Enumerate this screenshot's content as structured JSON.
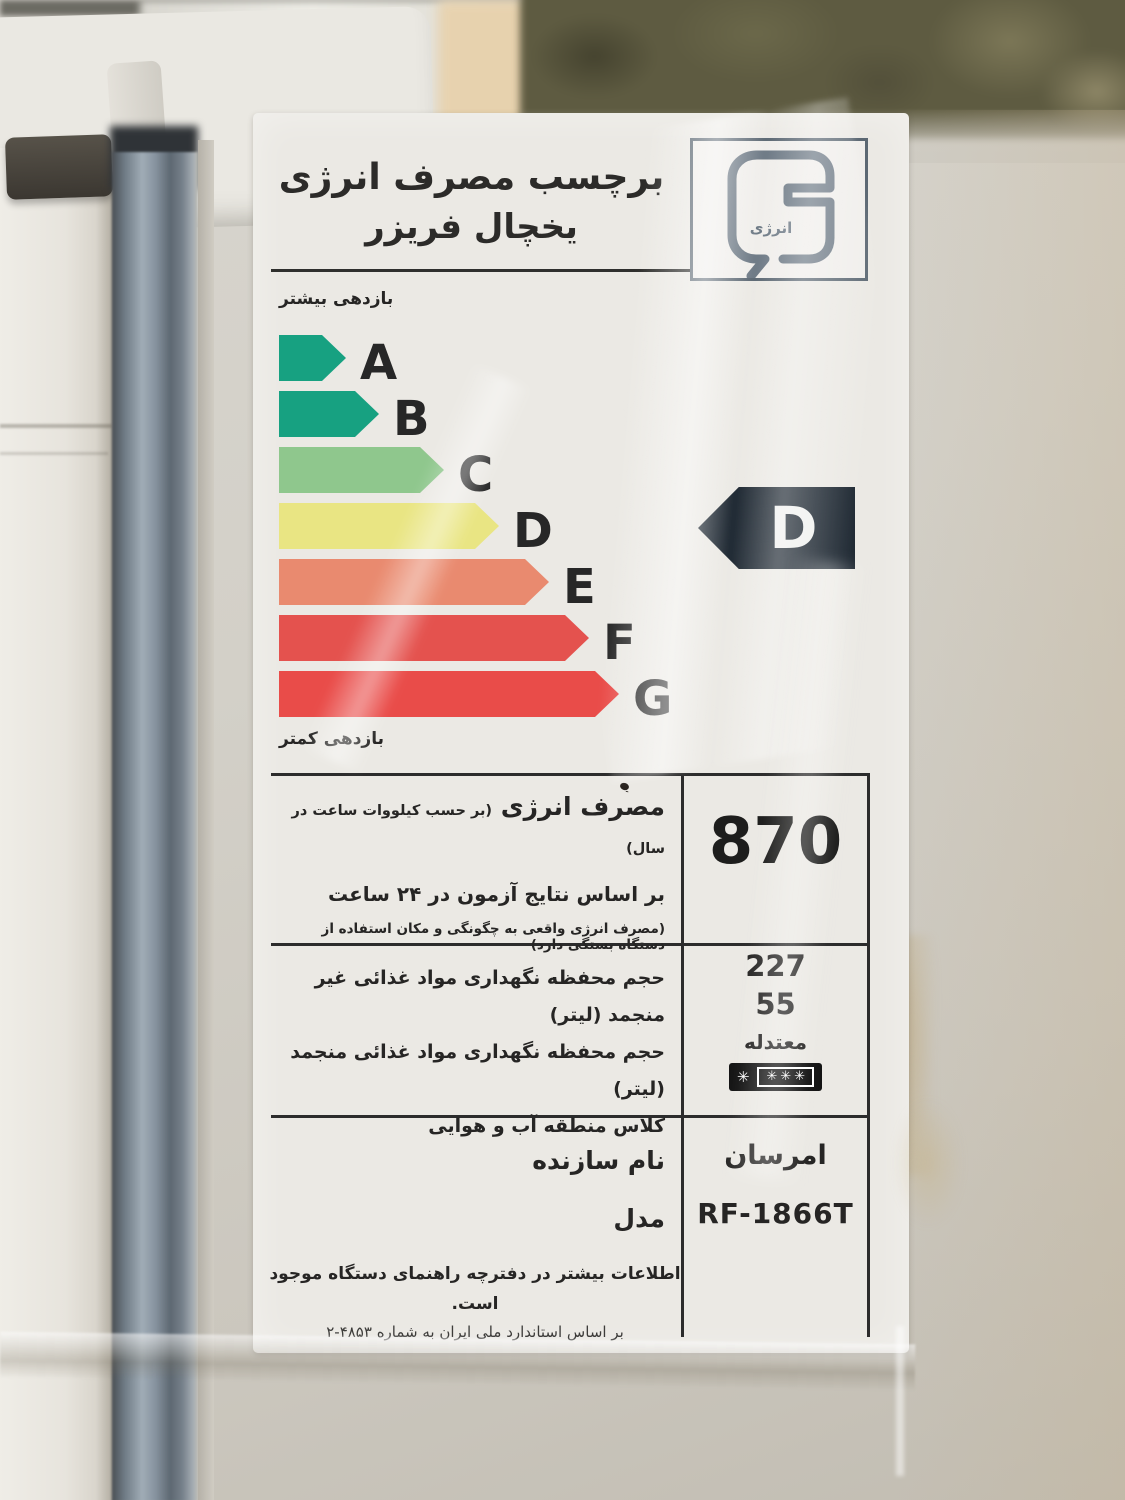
{
  "label": {
    "title_line1": "برچسب مصرف انرژی",
    "title_line2": "یخچال فریزر",
    "logo": {
      "text": "انرژی",
      "color": "#6d7985"
    },
    "scale": {
      "more_label": "بازدهی بیشتر",
      "less_label": "بازدهی کمتر",
      "grades": [
        {
          "letter": "A",
          "color": "#17a181",
          "width_px": 67
        },
        {
          "letter": "B",
          "color": "#17a181",
          "width_px": 100
        },
        {
          "letter": "C",
          "color": "#8fc78d",
          "width_px": 165
        },
        {
          "letter": "D",
          "color": "#e9e583",
          "width_px": 220
        },
        {
          "letter": "E",
          "color": "#e98a6f",
          "width_px": 270
        },
        {
          "letter": "F",
          "color": "#e4524e",
          "width_px": 310
        },
        {
          "letter": "G",
          "color": "#e94c49",
          "width_px": 340
        }
      ],
      "rating": {
        "letter": "D",
        "color": "#1e2832",
        "text_color": "#f0f1ef"
      }
    },
    "energy_section": {
      "heading_bold": "مصرف انرژی",
      "heading_small": "(بر حسب کیلووات ساعت در سال)",
      "line2": "بر اساس نتایج آزمون در ۲۴ ساعت",
      "line3": "(مصرف انرژی واقعی به چگونگی و مکان استفاده از دستگاه بستگی دارد)",
      "value_kwh_per_year": "870"
    },
    "specs_section": {
      "rows": [
        {
          "label": "حجم محفظه نگهداری مواد غذائی غیر منجمد (لیتر)",
          "value": "227"
        },
        {
          "label": "حجم محفظه نگهداری مواد غذائی منجمد (لیتر)",
          "value": "55"
        },
        {
          "label": "کلاس منطقه آب و هوایی",
          "value": "معتدله"
        }
      ],
      "freezer_stars": {
        "single": "✳",
        "triple": "✳✳✳"
      }
    },
    "maker_section": {
      "maker_label": "نام سازنده",
      "maker_value": "امرسان",
      "model_label": "مدل",
      "model_value": "RF-1866T"
    },
    "footnote_line1": "اطلاعات بیشتر در دفترچه راهنمای دستگاه موجود است.",
    "footnote_line2": "بر اساس استاندارد ملی ایران به شماره ۴۸۵۳-۲"
  }
}
